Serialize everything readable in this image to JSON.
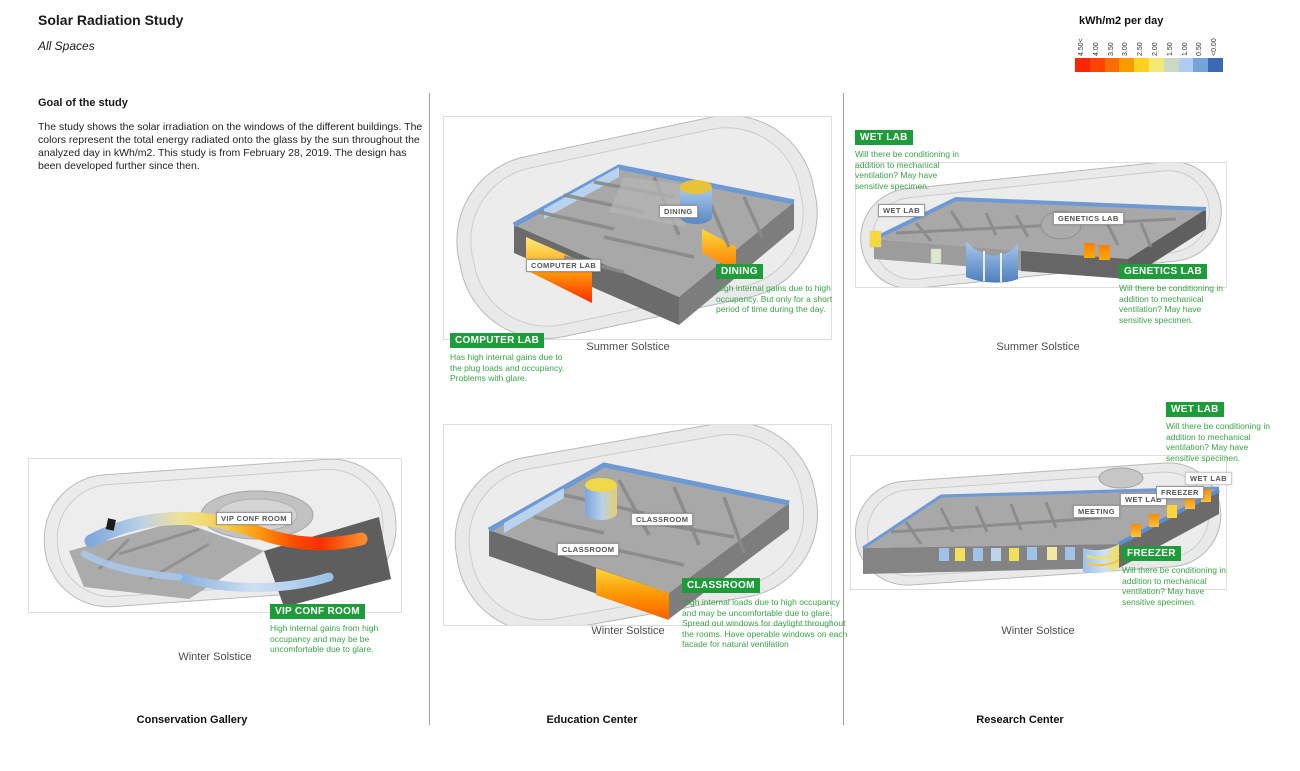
{
  "colors": {
    "accent_green": "#1e9c3a",
    "green_text": "#3ba24a",
    "divider": "#ab9d90"
  },
  "header": {
    "title": "Solar Radiation Study",
    "subtitle": "All Spaces"
  },
  "legend": {
    "title": "kWh/m2 per day",
    "items": [
      {
        "label": "4.50<",
        "color": "#f92700"
      },
      {
        "label": "4.00",
        "color": "#fa4500"
      },
      {
        "label": "3.50",
        "color": "#fb6c00"
      },
      {
        "label": "3.00",
        "color": "#fc9b00"
      },
      {
        "label": "2.50",
        "color": "#fdd21f"
      },
      {
        "label": "2.00",
        "color": "#f3e871"
      },
      {
        "label": "1.50",
        "color": "#cbd8c3"
      },
      {
        "label": "1.00",
        "color": "#aecdf0"
      },
      {
        "label": "0.50",
        "color": "#74a3d8"
      },
      {
        "label": "<0.00",
        "color": "#3a69af"
      }
    ]
  },
  "goal": {
    "heading": "Goal of the study",
    "body": "The study shows the solar irradiation on the windows of the different buildings. The colors represent the total energy radiated onto the glass by the sun throughout the analyzed day in kWh/m2. This study is from February 28, 2019. The design has been developed further since then."
  },
  "columns": {
    "conservation": {
      "title": "Conservation Gallery"
    },
    "education": {
      "title": "Education Center"
    },
    "research": {
      "title": "Research Center"
    }
  },
  "captions": {
    "summer": "Summer Solstice",
    "winter": "Winter Solstice"
  },
  "room_labels": {
    "dining": "DINING",
    "computer_lab": "COMPUTER LAB",
    "classroom": "CLASSROOM",
    "wet_lab": "WET LAB",
    "genetics_lab": "GENETICS LAB",
    "freezer": "FREEZER",
    "meeting": "MEETING",
    "vip_conf_room": "VIP CONF ROOM"
  },
  "annotations": {
    "computer_lab": {
      "label": "COMPUTER LAB",
      "text": "Has high internal gains due to the plug loads and occupancy. Problems with glare."
    },
    "dining": {
      "label": "DINING",
      "text": "High internal gains due to high occupancy. But only for a short period of time during the day."
    },
    "classroom": {
      "label": "CLASSROOM",
      "text": "High internal loads due to high occupancy and may be uncomfortable due to glare. Spread out windows for daylight throughout the rooms. Have operable windows on each facade for natural ventilation"
    },
    "wet_lab_summer": {
      "label": "WET LAB",
      "text": "Will there be conditioning in addition to mechanical ventilation? May have sensitive specimen."
    },
    "genetics_lab": {
      "label": "GENETICS LAB",
      "text": "Will there be conditioning in addition to mechanical ventilation? May have sensitive specimen."
    },
    "wet_lab_winter": {
      "label": "WET LAB",
      "text": "Will there be conditioning in addition to mechanical ventilation? May have sensitive specimen."
    },
    "freezer": {
      "label": "FREEZER",
      "text": "Will there be conditioning in addition to mechanical ventilation? May have sensitive specimen."
    },
    "vip_conf_room": {
      "label": "VIP CONF ROOM",
      "text": "High internal gains from high occupancy and may be be uncomfortable due to glare."
    }
  }
}
